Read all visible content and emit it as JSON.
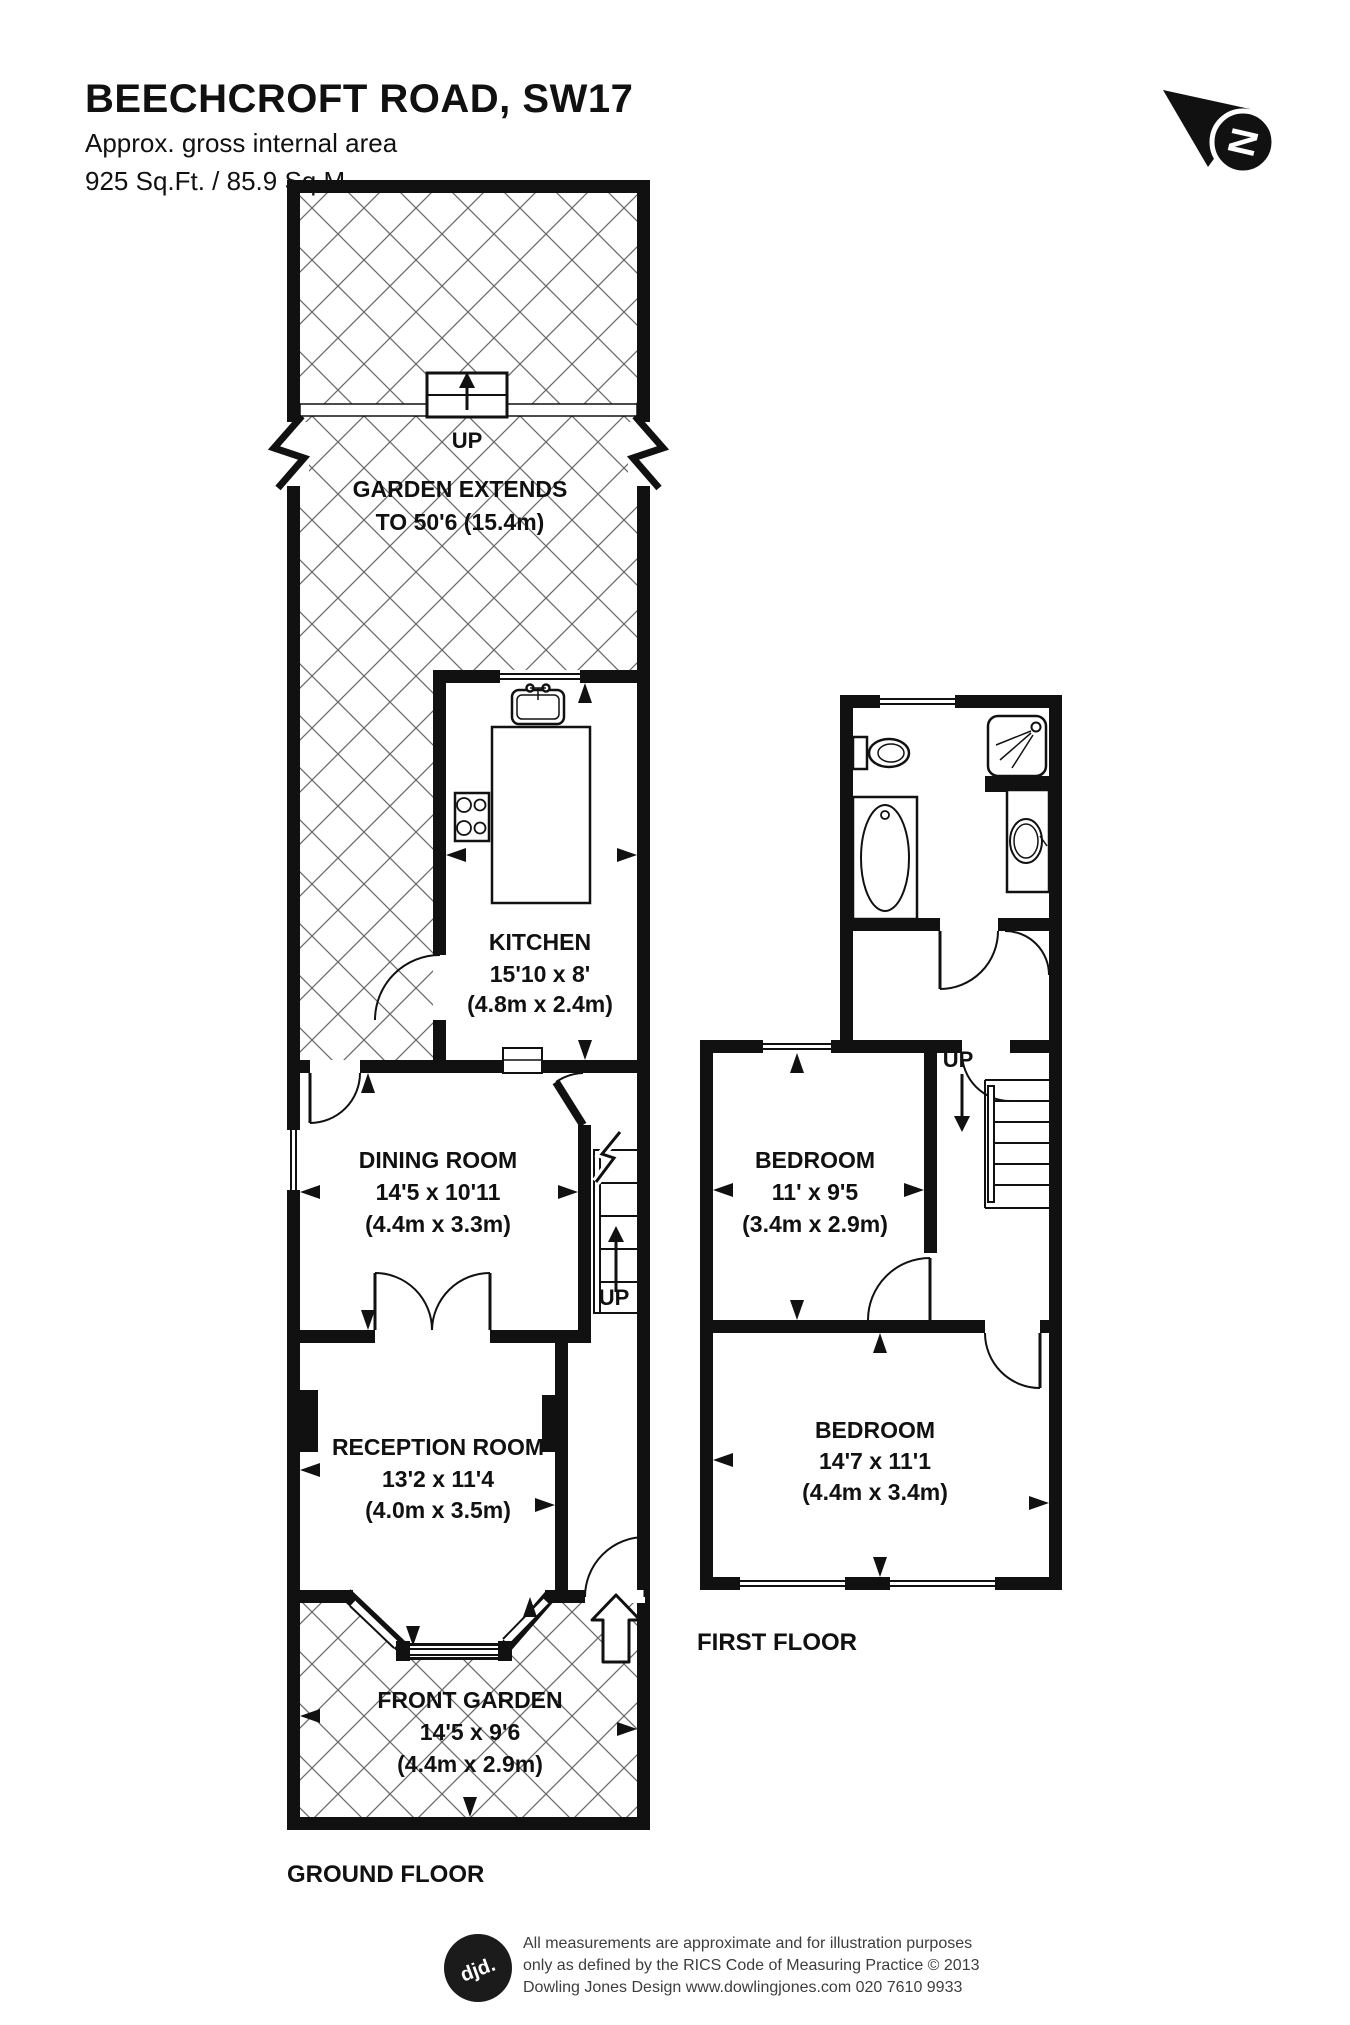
{
  "header": {
    "title": "BEECHCROFT ROAD, SW17",
    "subtitle1": "Approx. gross internal area",
    "subtitle2": "925 Sq.Ft. / 85.9 Sq.M."
  },
  "north_arrow": {
    "letter": "N"
  },
  "ground_floor": {
    "floor_label": "GROUND FLOOR",
    "garden": {
      "up": "UP",
      "line1": "GARDEN EXTENDS",
      "line2": "TO 50'6 (15.4m)"
    },
    "kitchen": {
      "name": "KITCHEN",
      "imperial": "15'10 x 8'",
      "metric": "(4.8m x 2.4m)"
    },
    "dining": {
      "name": "DINING ROOM",
      "imperial": "14'5 x 10'11",
      "metric": "(4.4m x 3.3m)"
    },
    "stairs_up": "UP",
    "reception": {
      "name": "RECEPTION ROOM",
      "imperial": "13'2 x 11'4",
      "metric": "(4.0m x 3.5m)"
    },
    "front_garden": {
      "name": "FRONT GARDEN",
      "imperial": "14'5 x 9'6",
      "metric": "(4.4m x 2.9m)"
    }
  },
  "first_floor": {
    "floor_label": "FIRST FLOOR",
    "stairs_up": "UP",
    "bedroom1": {
      "name": "BEDROOM",
      "imperial": "11' x 9'5",
      "metric": "(3.4m x 2.9m)"
    },
    "bedroom2": {
      "name": "BEDROOM",
      "imperial": "14'7 x 11'1",
      "metric": "(4.4m x 3.4m)"
    }
  },
  "footer": {
    "logo": "djd.",
    "line1": "All measurements are approximate and for illustration purposes",
    "line2": "only as defined by the RICS Code of Measuring Practice © 2013",
    "line3": "Dowling Jones Design www.dowlingjones.com 020 7610 9933"
  },
  "colors": {
    "ink": "#111111",
    "hatch": "#6b6b6b",
    "footer_text": "#3d3d3d"
  }
}
